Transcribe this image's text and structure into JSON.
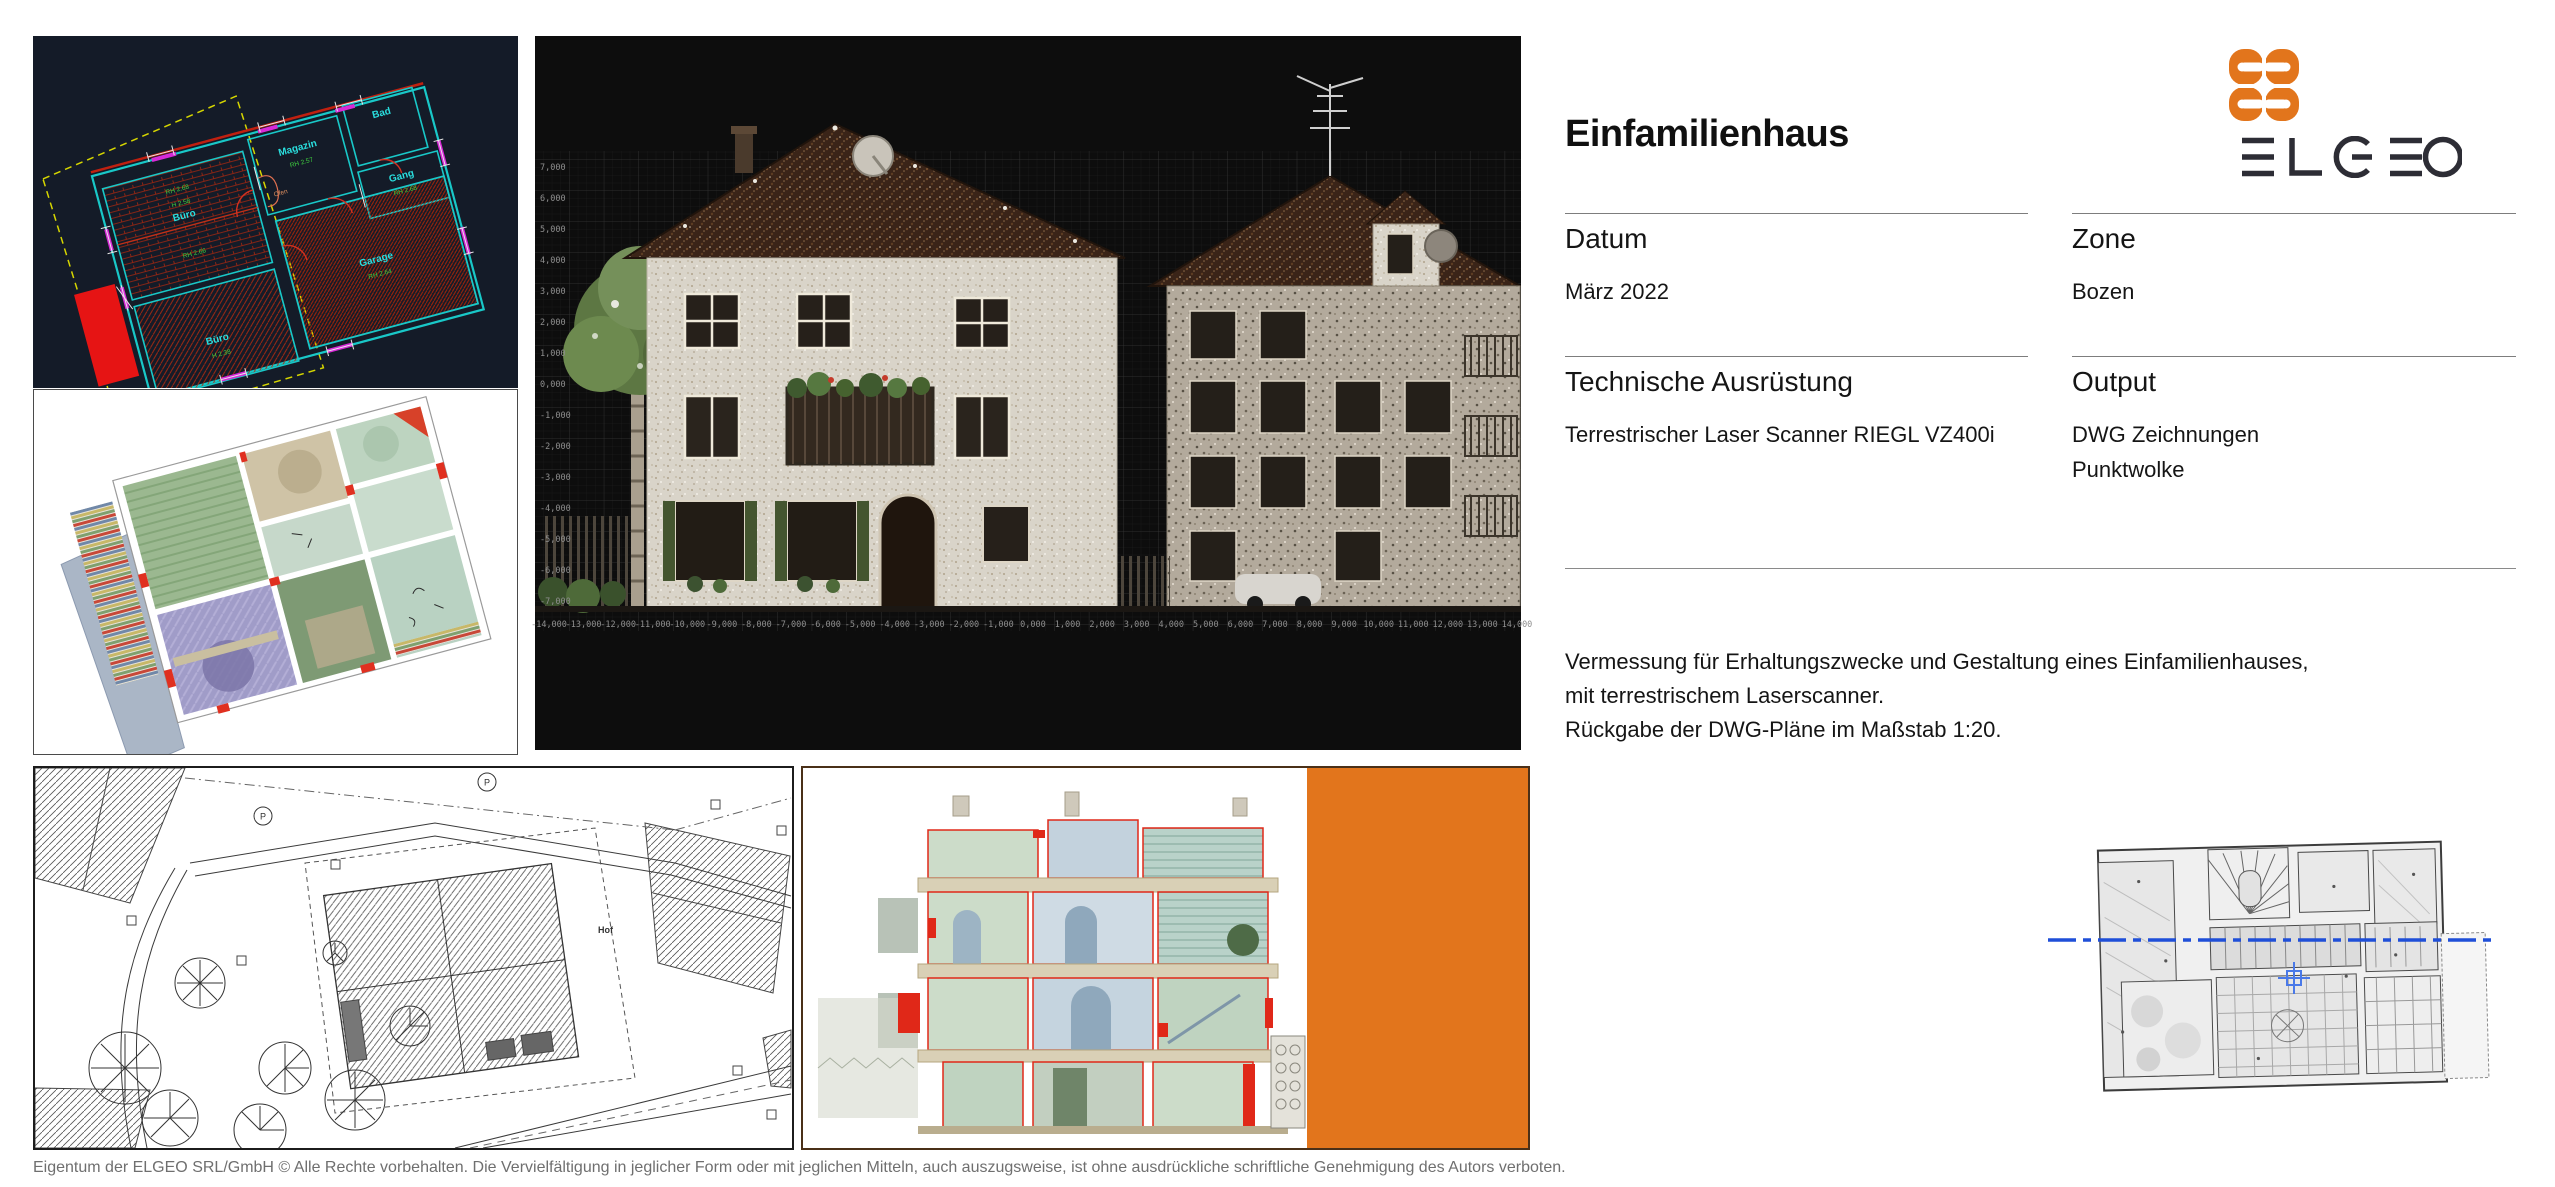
{
  "header": {
    "title": "Einfamilienhaus"
  },
  "logo": {
    "wordmark": "ELGEO",
    "orange": "#E2751C",
    "dark": "#2D2D35"
  },
  "panel": {
    "fields": [
      {
        "label": "Datum",
        "value": "März 2022"
      },
      {
        "label": "Zone",
        "value": "Bozen"
      },
      {
        "label": "Technische Ausrüstung",
        "value": "Terrestrischer Laser Scanner RIEGL VZ400i"
      },
      {
        "label": "Output",
        "value": "DWG Zeichnungen",
        "value2": "Punktwolke"
      }
    ],
    "description_lines": [
      "Vermessung für Erhaltungszwecke und Gestaltung eines Einfamilienhauses,",
      "mit terrestrischem Laserscanner.",
      "Rückgabe der DWG-Pläne im Maßstab 1:20."
    ]
  },
  "footer": {
    "copyright": "Eigentum der ELGEO SRL/GmbH © Alle Rechte vorbehalten. Die Vervielfältigung in jeglicher Form oder mit jeglichen Mitteln, auch auszugsweise, ist ohne ausdrückliche schriftliche Genehmigung des Autors verboten."
  },
  "cad": {
    "rooms": [
      "Büro",
      "Magazin",
      "Bad",
      "Gang",
      "Garage",
      "Büro"
    ],
    "annotations": [
      "RH 2.68",
      "H 2.58",
      "RH 2.57",
      "RH 2.66",
      "H 2.38",
      "RH 2.64",
      "RH 2.68",
      "Ofen"
    ],
    "colors": {
      "background": "#141B28",
      "walls": "#19C8C8",
      "hatch": "#B02A10",
      "windows": "#D82AD8",
      "boundary": "#D6D600",
      "labels": "#2ADFDF",
      "heights": "#3FD03F"
    }
  },
  "viewer": {
    "x_ticks": [
      "-14,000",
      "-13,000",
      "-12,000",
      "-11,000",
      "-10,000",
      "-9,000",
      "-8,000",
      "-7,000",
      "-6,000",
      "-5,000",
      "-4,000",
      "-3,000",
      "-2,000",
      "-1,000",
      "0,000",
      "1,000",
      "2,000",
      "3,000",
      "4,000",
      "5,000",
      "6,000",
      "7,000",
      "8,000",
      "9,000",
      "10,000",
      "11,000",
      "12,000",
      "13,000",
      "14,000"
    ],
    "y_ticks": [
      "7,000",
      "6,000",
      "5,000",
      "4,000",
      "3,000",
      "2,000",
      "1,000",
      "0,000",
      "-1,000",
      "-2,000",
      "-3,000",
      "-4,000",
      "-5,000",
      "-6,000",
      "-7,000"
    ],
    "background": "#0D0D0D"
  },
  "site": {
    "hof": "Hof",
    "p": "P"
  },
  "cross_section": {
    "accent": "#E2751C"
  }
}
